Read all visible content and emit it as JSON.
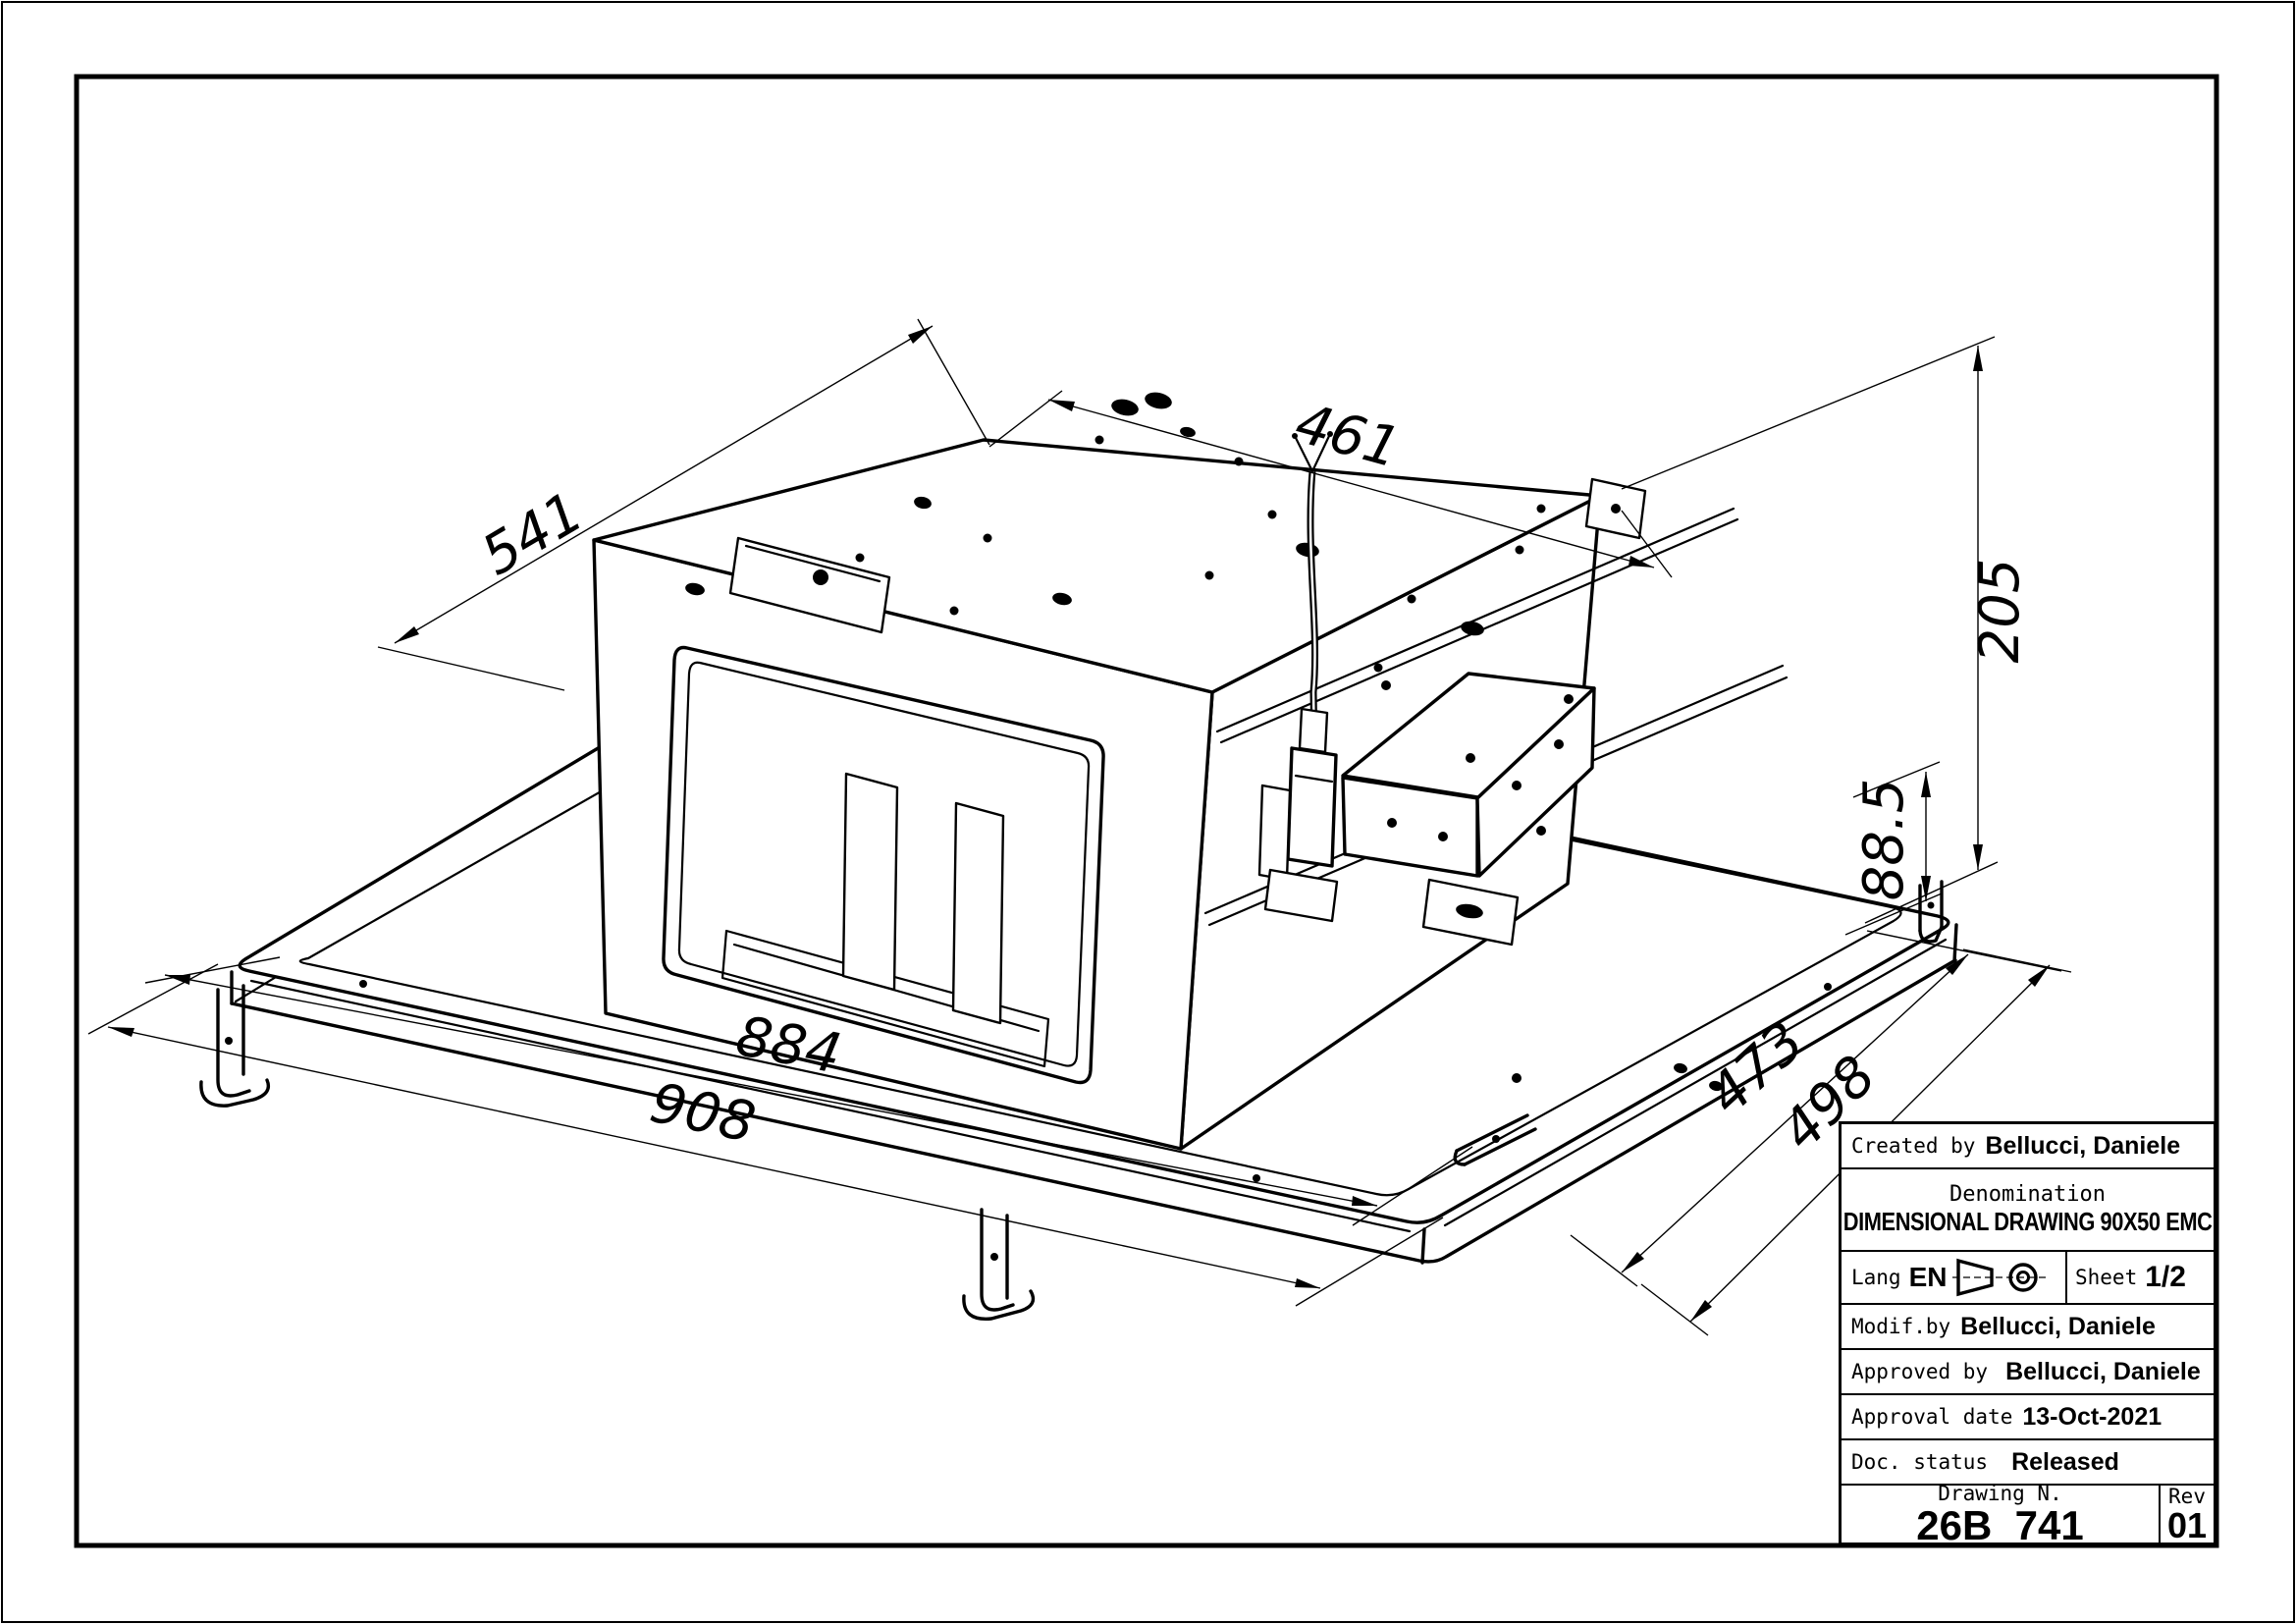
{
  "page": {
    "background": "#ffffff",
    "line_color": "#000000",
    "type_note": "technical dimensional drawing, trimetric view of built-in hood chassis"
  },
  "dimensions": {
    "depth_top": "541",
    "width_top": "461",
    "height_total": "205",
    "height_base": "88.5",
    "width_inner": "884",
    "width_outer": "908",
    "depth_inner": "473",
    "depth_outer": "498"
  },
  "title_block": {
    "created_by_label": "Created by",
    "created_by": "Bellucci, Daniele",
    "denomination_label": "Denomination",
    "denomination": "DIMENSIONAL DRAWING 90X50 EMC",
    "lang_label": "Lang",
    "lang": "EN",
    "sheet_label": "Sheet",
    "sheet": "1/2",
    "modif_label": "Modif.by",
    "modif_by": "Bellucci,  Daniele",
    "approved_label": "Approved by",
    "approved_by": "Bellucci, Daniele",
    "approval_date_label": "Approval date",
    "approval_date": "13-Oct-2021",
    "doc_status_label": "Doc. status",
    "doc_status": "Released",
    "drawing_n_label": "Drawing N.",
    "drawing_n": "26B_741",
    "rev_label": "Rev",
    "rev": "01"
  },
  "icons": {
    "projection_symbol": "first-angle-projection-icon"
  }
}
